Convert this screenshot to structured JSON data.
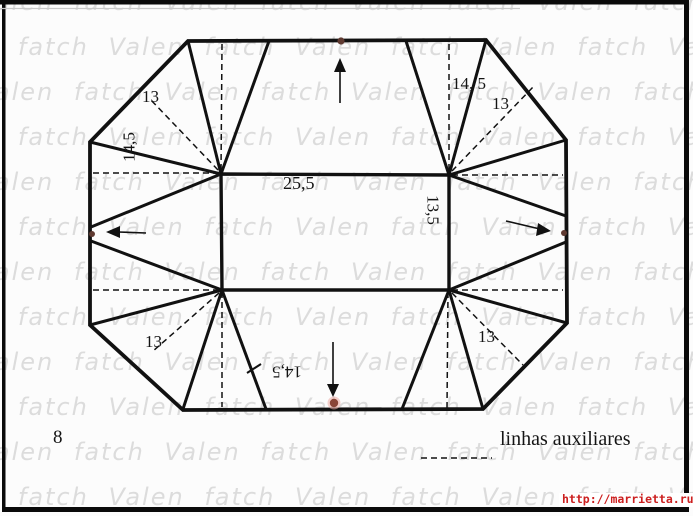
{
  "page": {
    "background": "#fcfcfc",
    "description_visible_text_language": "pt"
  },
  "colors": {
    "line": "#111111",
    "frame": "#0a0a0a",
    "dot_brown": "#5f3a31",
    "dot_red": "#8a4538",
    "dot_halo": "#edaaa2",
    "url_red": "#cc2020",
    "watermark_gray": "#dcdcdc",
    "background": "#fcfcfc"
  },
  "watermark": {
    "word_1": "Valen",
    "word_2": "fatch",
    "row_text": "Valen fatch Valen fatch Valen fatch Valen fatch Valen fatch Valen fatch",
    "rows": 12,
    "row_spacing_px": 45
  },
  "labels": {
    "dim_13_top_left": "13",
    "dim_14_5_left": "14,5",
    "dim_14_5_top_right": "14, 5",
    "dim_13_top_right": "13",
    "dim_25_5_width": "25,5",
    "dim_13_5_height": "13,5",
    "dim_13_bottom_left": "13",
    "dim_13_bottom_right": "13",
    "dim_14_5_bottom": "14,5",
    "step_number": "8",
    "legend_label": "linhas auxiliares",
    "watermark_url": "http://marrietta.ru/"
  },
  "icons": {
    "arrow_up": "fold direction arrow pointing up",
    "arrow_down": "fold direction arrow pointing down",
    "arrow_left": "fold direction arrow pointing left",
    "arrow_right": "fold direction arrow pointing right",
    "edge_dots": "small brown/red dots marking fold points on each outer edge"
  }
}
